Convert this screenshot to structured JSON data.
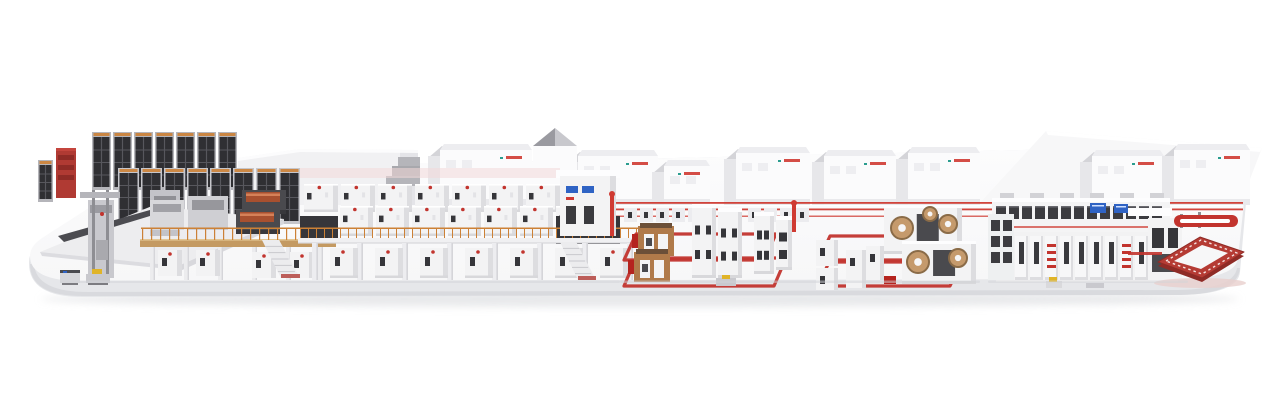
{
  "scene": {
    "label": "3D render of a complete corrugated board production line displayed on a white rounded platform",
    "palette": {
      "background": "#ffffff",
      "platform_top": "#f7f7f8",
      "platform_top_light": "#fcfcfd",
      "platform_face": "#e6e7ea",
      "platform_lip": "#d6d7db",
      "drop_shadow": "#dcdde0",
      "machine_white": "#f3f3f4",
      "machine_shade": "#dddde0",
      "machine_dark": "#36363a",
      "accent_red": "#c2342e",
      "bright_red": "#cf3a32",
      "dark_red": "#8f2b26",
      "orange": "#cc8136",
      "wood": "#c49a62",
      "copper": "#a8502f",
      "steel": "#b5b5ba",
      "steel_dark": "#8e8e93",
      "screen_blue": "#2f63c4",
      "screen_blue_light": "#cfe0ff",
      "yellow": "#e0b428",
      "glass_dark": "#3c3c40",
      "building_front": "#fbfbfc",
      "building_side": "#e7e7ea",
      "roof_light": "#ededf0",
      "gable_dark": "#9a9aa0",
      "teal_logo": "#2a9d8f"
    },
    "sections": [
      {
        "id": "roll-storage",
        "back_racks": 7,
        "front_racks": 8
      },
      {
        "id": "splicer-wet-end",
        "roll_units": 2
      },
      {
        "id": "corrugator-line",
        "back_modules": 8,
        "mid_modules": 7,
        "ground_cabinets": 7,
        "support_columns": 8
      },
      {
        "id": "dry-end-tower",
        "status_panels": 2
      },
      {
        "id": "conversion-area-1",
        "floor_loops": 2,
        "machine_towers": 4
      },
      {
        "id": "conversion-area-2",
        "floor_loops": 2,
        "die_cutters": 2
      },
      {
        "id": "sorting-logistics-line",
        "gallery_windows": 13,
        "cabinets": 12,
        "displays": 2
      },
      {
        "id": "elevated-conveyor",
        "capsules": 1,
        "rings": 1
      }
    ],
    "background_buildings": {
      "gables": 8,
      "dark_towers": 1,
      "flat_slabs": 2
    },
    "agv_carts": 4
  }
}
